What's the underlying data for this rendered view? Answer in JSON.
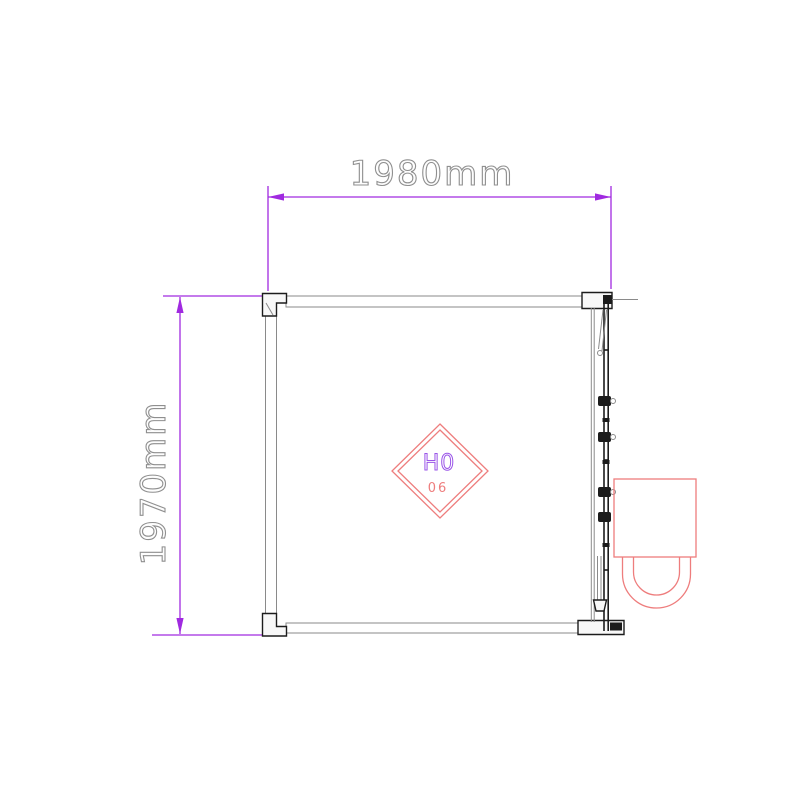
{
  "drawing": {
    "dimension_width_label": "1980mm",
    "dimension_height_label": "1970mm",
    "diamond_mark": {
      "code": "H0",
      "number": "06"
    }
  },
  "colors": {
    "dimension": "#a02ae0",
    "dimension_text": "#8f8f8f",
    "line_dark": "#1c1c1c",
    "line_gray": "#8a8a8a",
    "red_accent": "#ee7d7d",
    "mark_purple": "#9a55e8",
    "background": "#ffffff"
  }
}
